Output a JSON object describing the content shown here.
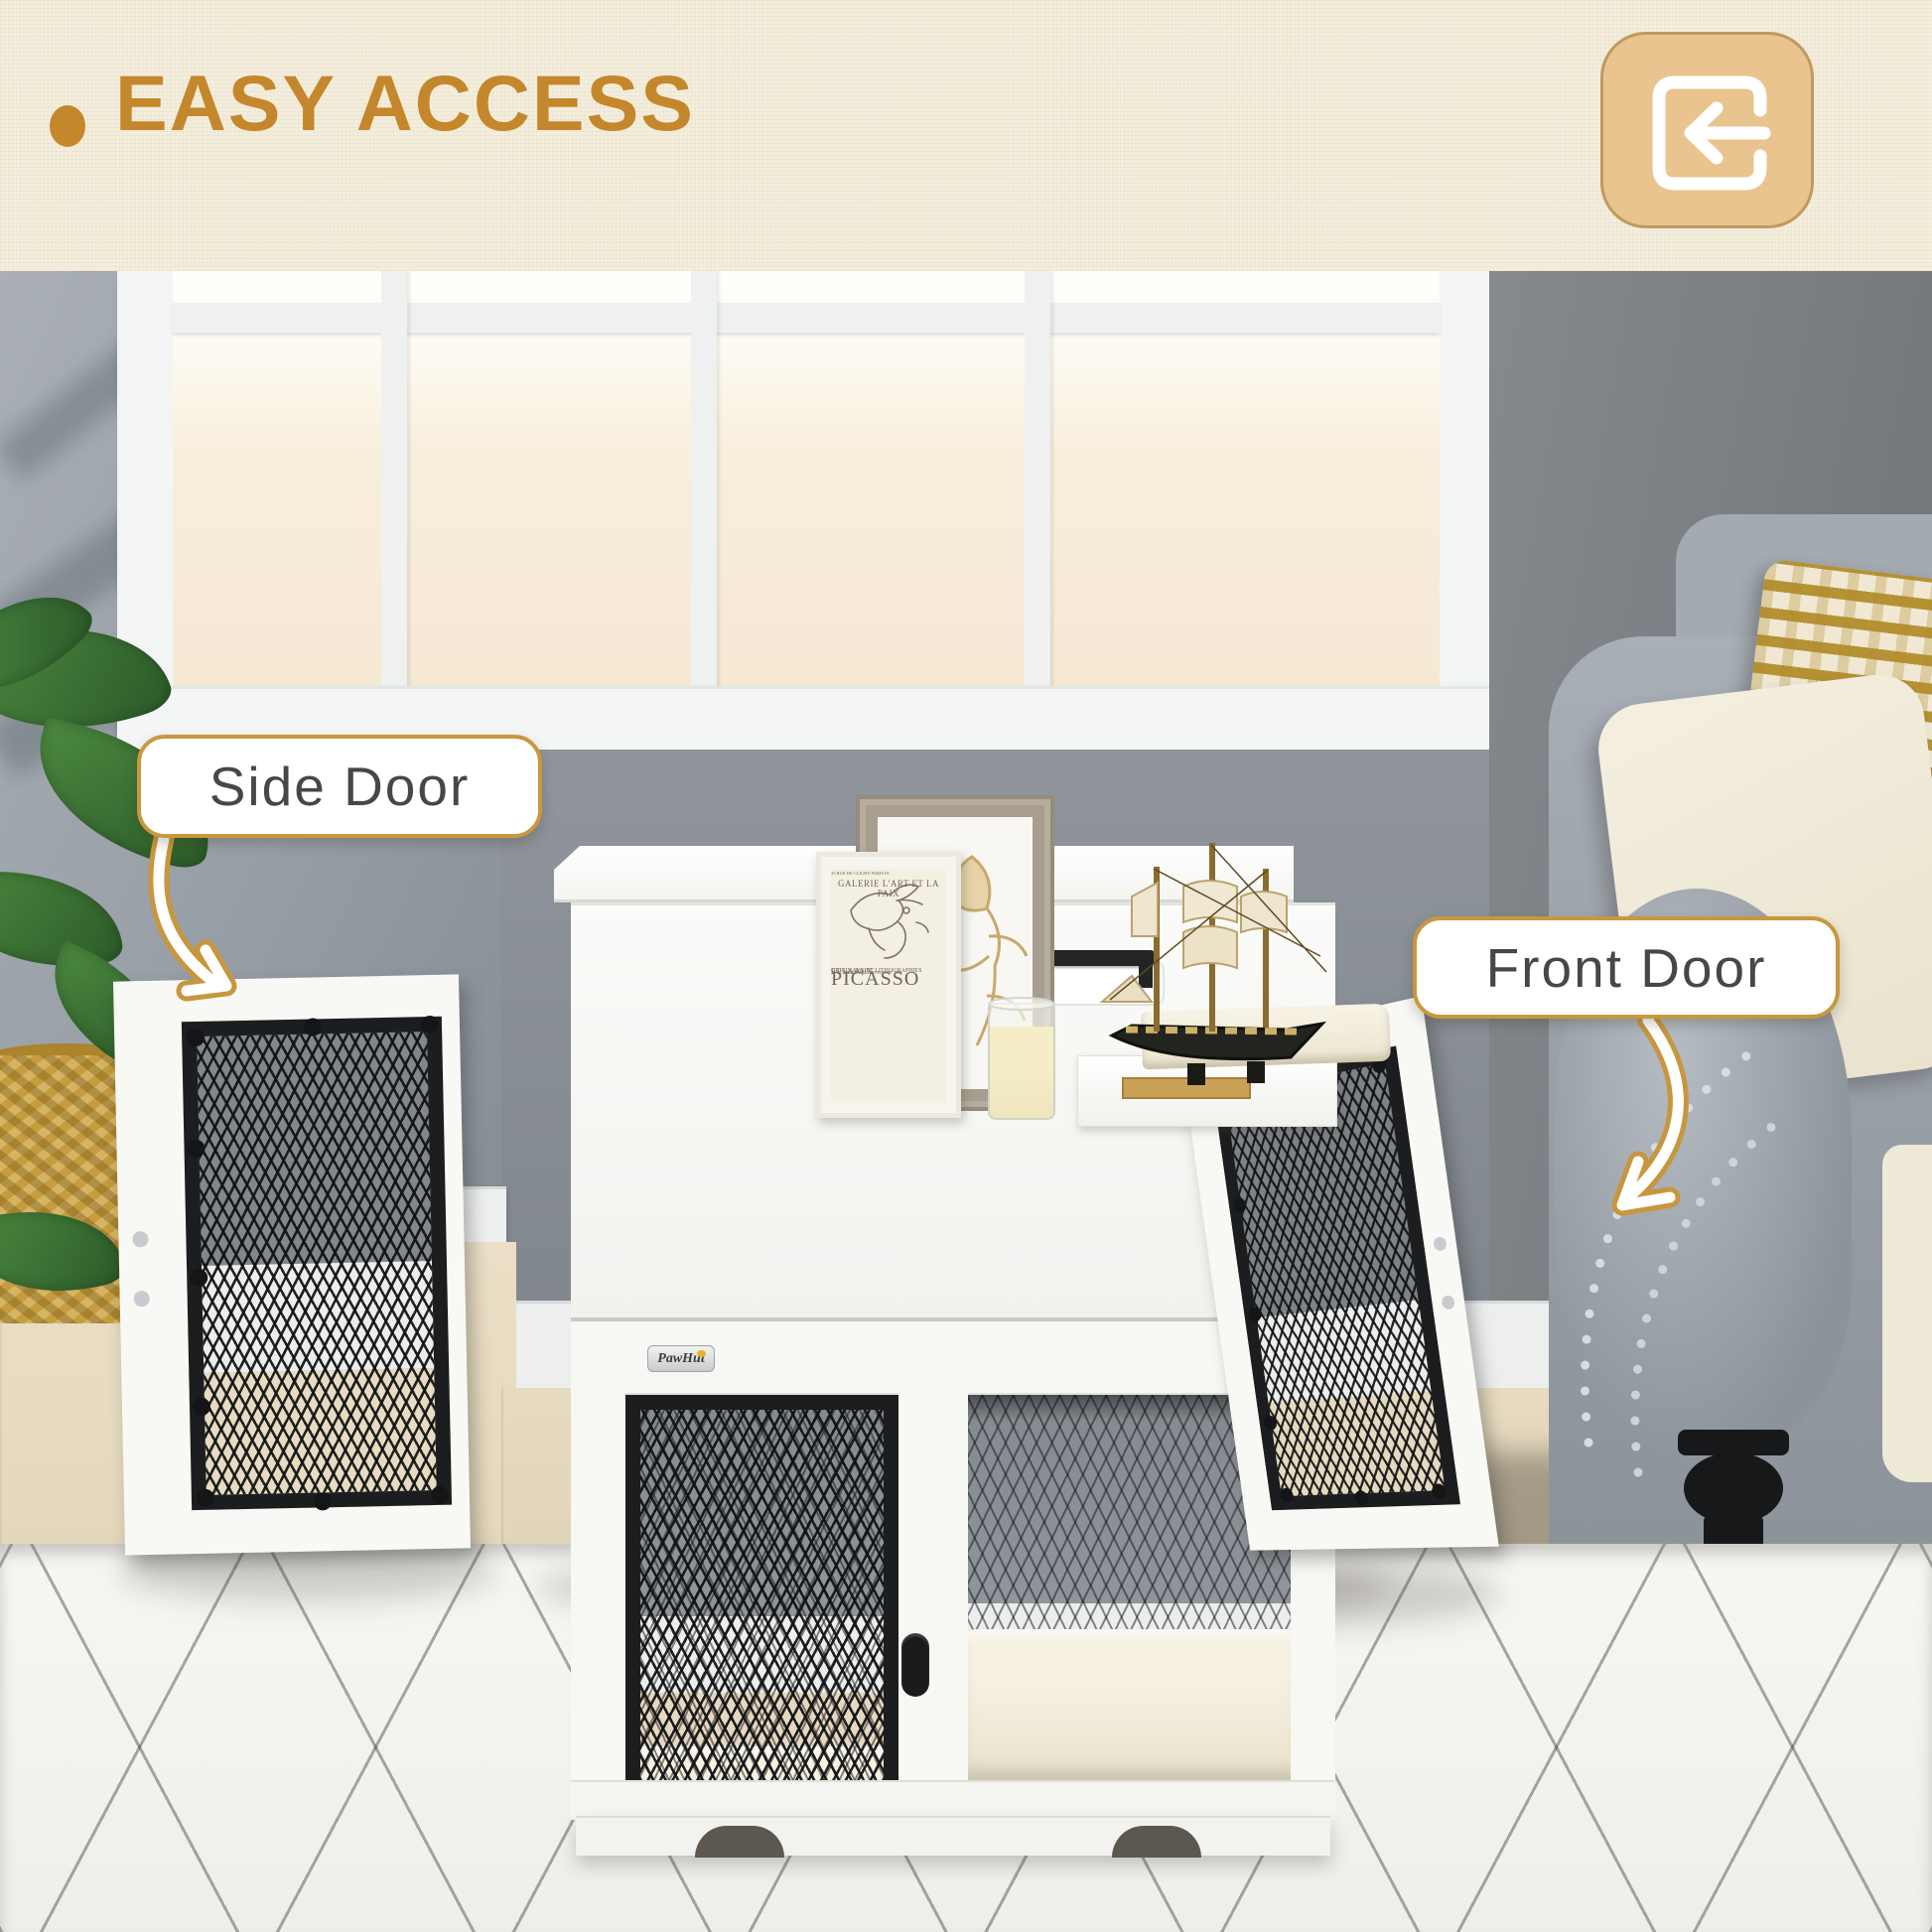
{
  "banner": {
    "bullet": "•",
    "title": "EASY ACCESS",
    "accent_color": "#c4872b",
    "background_color": "#f4eedd"
  },
  "corner_icon": {
    "name": "sign-in-icon",
    "tile_color": "#e9c48e",
    "glyph_color": "#ffffff"
  },
  "callouts": {
    "side": {
      "label": "Side Door"
    },
    "front": {
      "label": "Front Door"
    },
    "border_color": "#c9973f",
    "text_color": "#474747"
  },
  "poster": {
    "line1": "GALERIE L'ART ET LA PAIX",
    "line2": "45 RUE DE CLICHY PARIS IX",
    "artist": "PICASSO",
    "line3": "ET LA PAIX",
    "line4": "ORIGINAUX ET LITHOGRAPHIES",
    "line5": "22 OCTOBRE – 13 NOVEMBRE 1951"
  },
  "brand_badge": {
    "label": "PawHut"
  },
  "scene_colors": {
    "mesh_black": "#1c1d1f",
    "crate_white": "#f8f8f5",
    "wall_grey": "#8d9399",
    "sofa_grey": "#969da4",
    "gold_pillow": "#b28d2c",
    "rug_white": "#f4f3f0"
  }
}
